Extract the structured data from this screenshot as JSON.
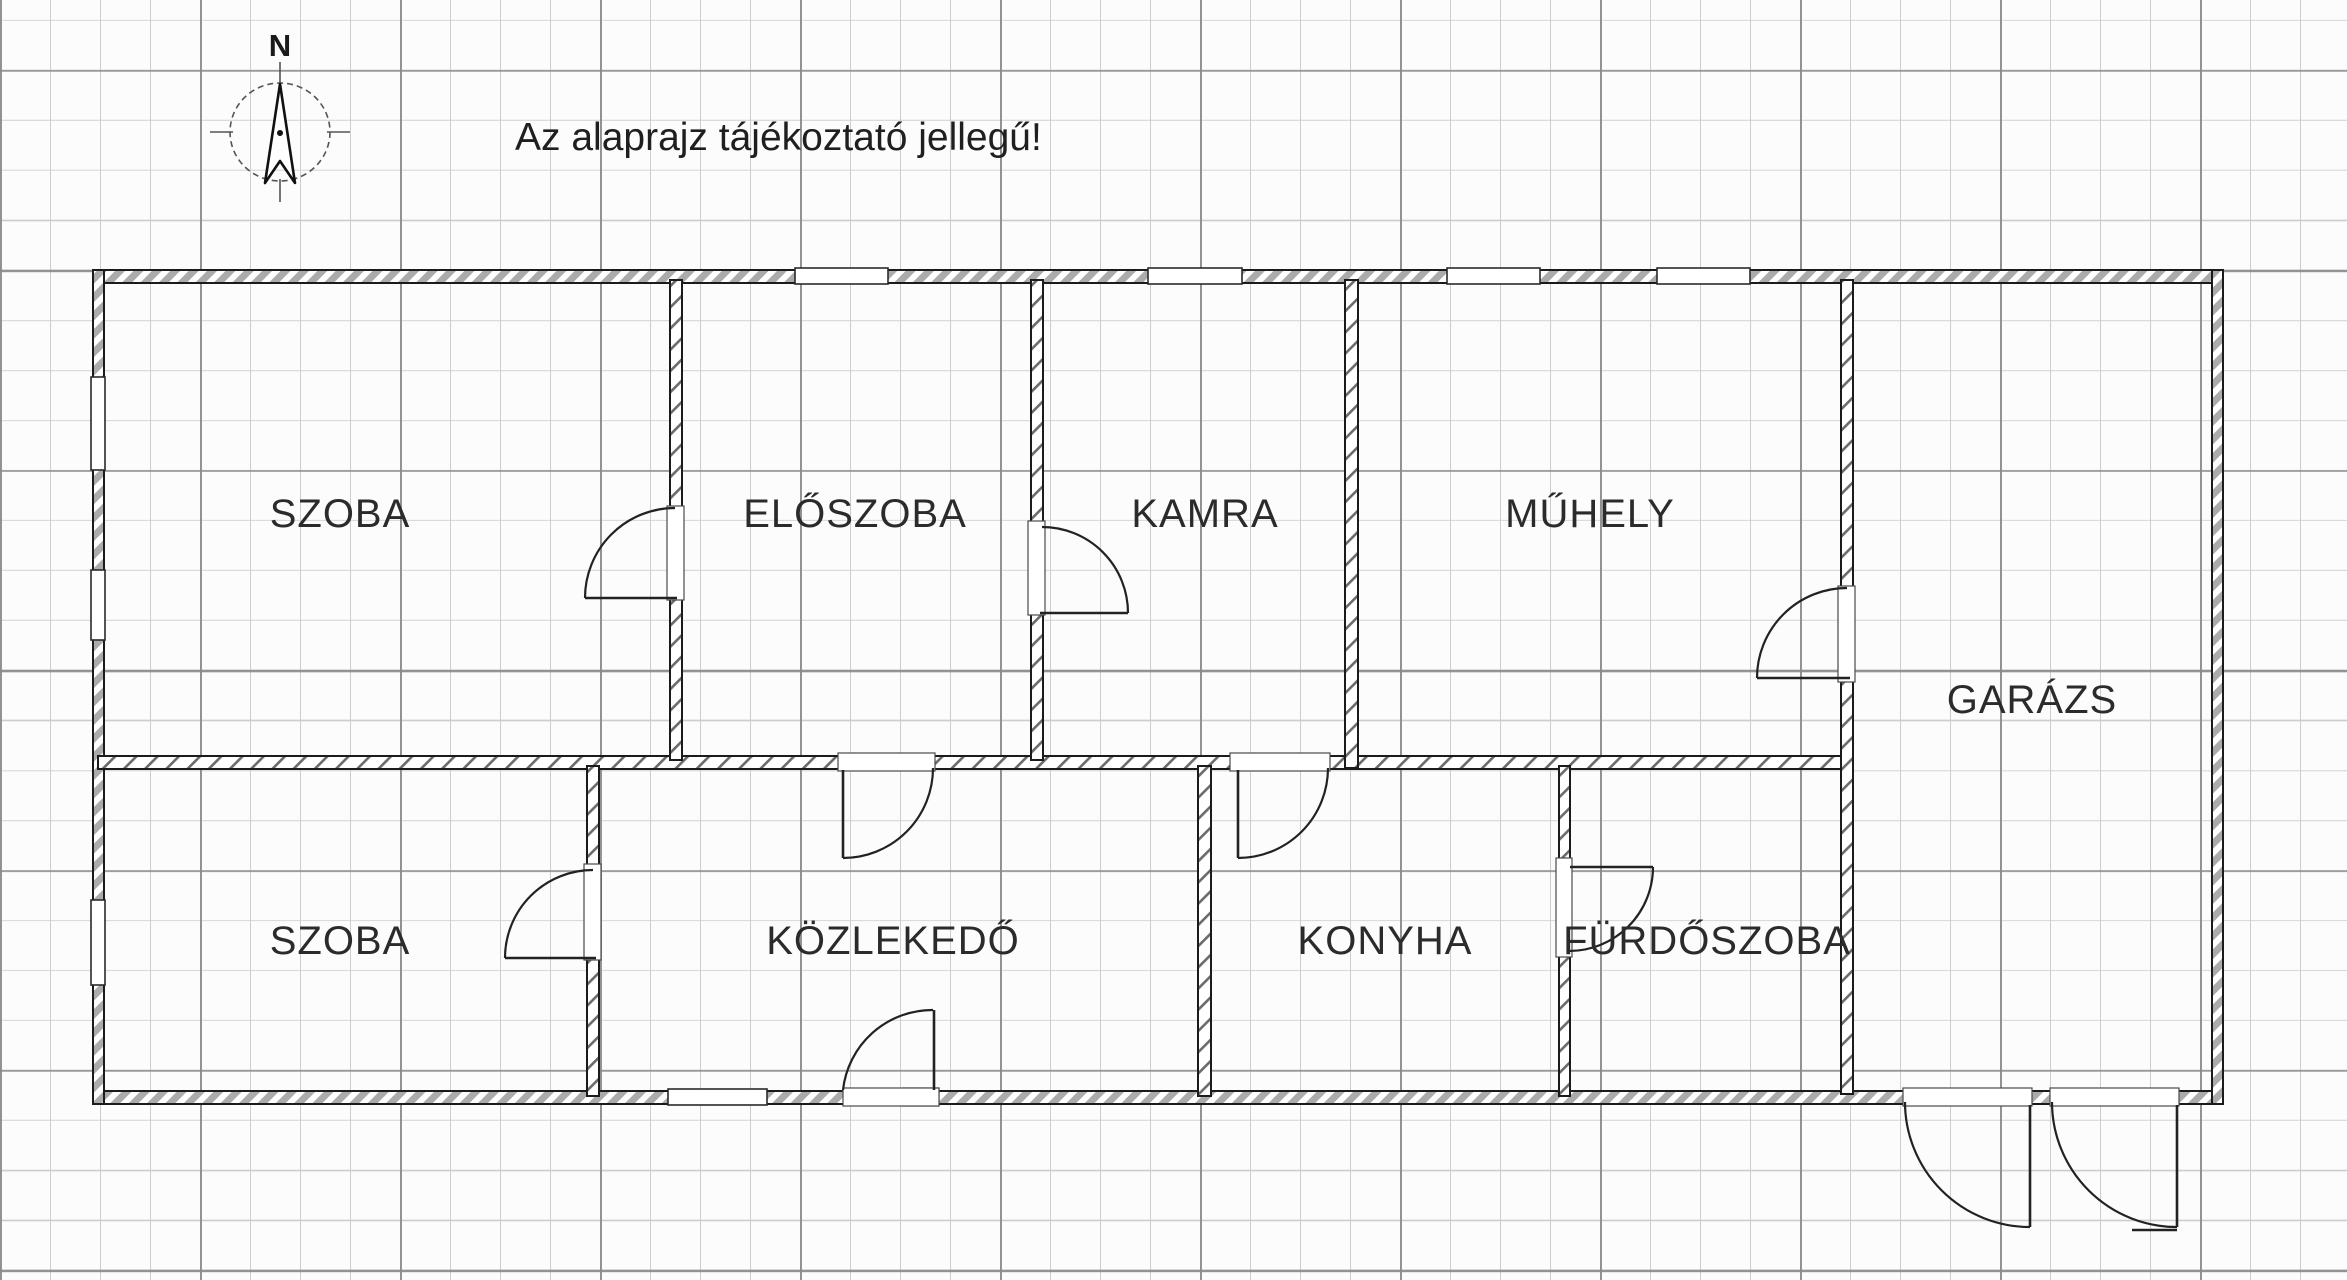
{
  "note": "Az alaprajz tájékoztató jellegű!",
  "compass": {
    "north_label": "N"
  },
  "rooms": {
    "szoba_top": "SZOBA",
    "eloszoba": "ELŐSZOBA",
    "kamra": "KAMRA",
    "muhely": "MŰHELY",
    "garazs": "GARÁZS",
    "szoba_bottom": "SZOBA",
    "kozlekedo": "KÖZLEKEDŐ",
    "konyha": "KONYHA",
    "furdoszoba": "FÜRDŐSZOBA"
  },
  "colors": {
    "wall_outline": "#1b1b1b",
    "exterior_hatch": "#ababab",
    "interior_hatch": "#6b6b6b",
    "grid_minor": "#cdcdcd",
    "grid_major": "#8a8a8a",
    "label_text": "#2b2b2b"
  }
}
